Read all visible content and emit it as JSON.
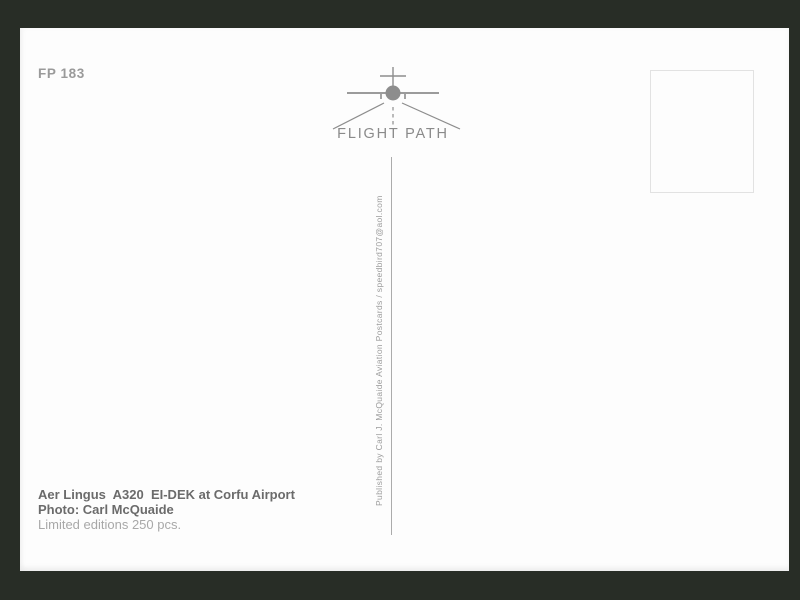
{
  "frame": {
    "background_color": "#282d26"
  },
  "card": {
    "background_color": "#fdfdfd",
    "catalog_number": "FP 183",
    "logo": {
      "brand": "FLIGHT PATH",
      "icon": "airplane-front-runway-icon",
      "color": "#8d8d8d"
    },
    "stamp_box": {
      "border_color": "#e2e2e2"
    },
    "divider_color": "#ababab",
    "publisher_line": "Published by Carl J. McQuaide Aviation Postcards / speedbird707@aol.com",
    "caption": {
      "title": "Aer Lingus  A320  EI-DEK at Corfu Airport",
      "photo_credit": "Photo: Carl McQuaide",
      "edition": "Limited editions 250 pcs."
    }
  }
}
